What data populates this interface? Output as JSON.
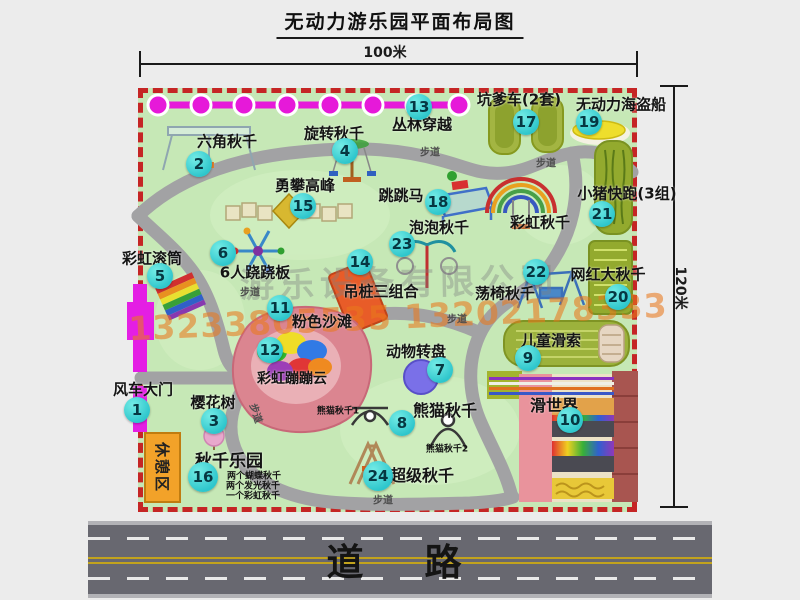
{
  "title": "无动力游乐园平面布局图",
  "dimensions": {
    "width": "100米",
    "height": "120米"
  },
  "road": {
    "label": "道　路"
  },
  "trail_label": "步道",
  "rest_area_label": "休憩区",
  "rainbow_swing_label": "彩虹秋千",
  "watermark": {
    "company": "游乐设备有限公司",
    "phones": "13233805535 13202178333"
  },
  "swing_park_notes": [
    "两个蝴蝶秋千",
    "两个发光秋千",
    "一个彩虹秋千"
  ],
  "panda_notes": [
    "熊猫秋千1",
    "熊猫秋千2"
  ],
  "colors": {
    "map_green": "#c6e8b6",
    "border_red": "#c52525",
    "badge_cyan": "#2ec6cc",
    "chain_magenta": "#e619d9",
    "gate_magenta": "#e41ee4",
    "rest_orange": "#f2a229",
    "road_gray": "#686870",
    "watermark_orange": "#e8791e"
  },
  "attractions": [
    {
      "num": "1",
      "label": "风车大门"
    },
    {
      "num": "2",
      "label": "六角秋千"
    },
    {
      "num": "3",
      "label": "樱花树"
    },
    {
      "num": "4",
      "label": "旋转秋千"
    },
    {
      "num": "5",
      "label": "彩虹滚筒"
    },
    {
      "num": "6",
      "label": "6人跷跷板"
    },
    {
      "num": "7",
      "label": "动物转盘"
    },
    {
      "num": "8",
      "label": "熊猫秋千"
    },
    {
      "num": "9",
      "label": "儿童滑索"
    },
    {
      "num": "10",
      "label": "滑世界"
    },
    {
      "num": "11",
      "label": "粉色沙滩"
    },
    {
      "num": "12",
      "label": "彩虹蹦蹦云"
    },
    {
      "num": "13",
      "label": "丛林穿越"
    },
    {
      "num": "14",
      "label": "吊桩三组合"
    },
    {
      "num": "15",
      "label": "勇攀高峰"
    },
    {
      "num": "16",
      "label": "秋千乐园"
    },
    {
      "num": "17",
      "label": "坑爹车(2套)"
    },
    {
      "num": "18",
      "label": "跳跳马"
    },
    {
      "num": "19",
      "label": "无动力海盗船"
    },
    {
      "num": "20",
      "label": "网红大秋千"
    },
    {
      "num": "21",
      "label": "小猪快跑(3组)"
    },
    {
      "num": "22",
      "label": "荡椅秋千"
    },
    {
      "num": "23",
      "label": "泡泡秋千"
    },
    {
      "num": "24",
      "label": "超级秋千"
    }
  ]
}
